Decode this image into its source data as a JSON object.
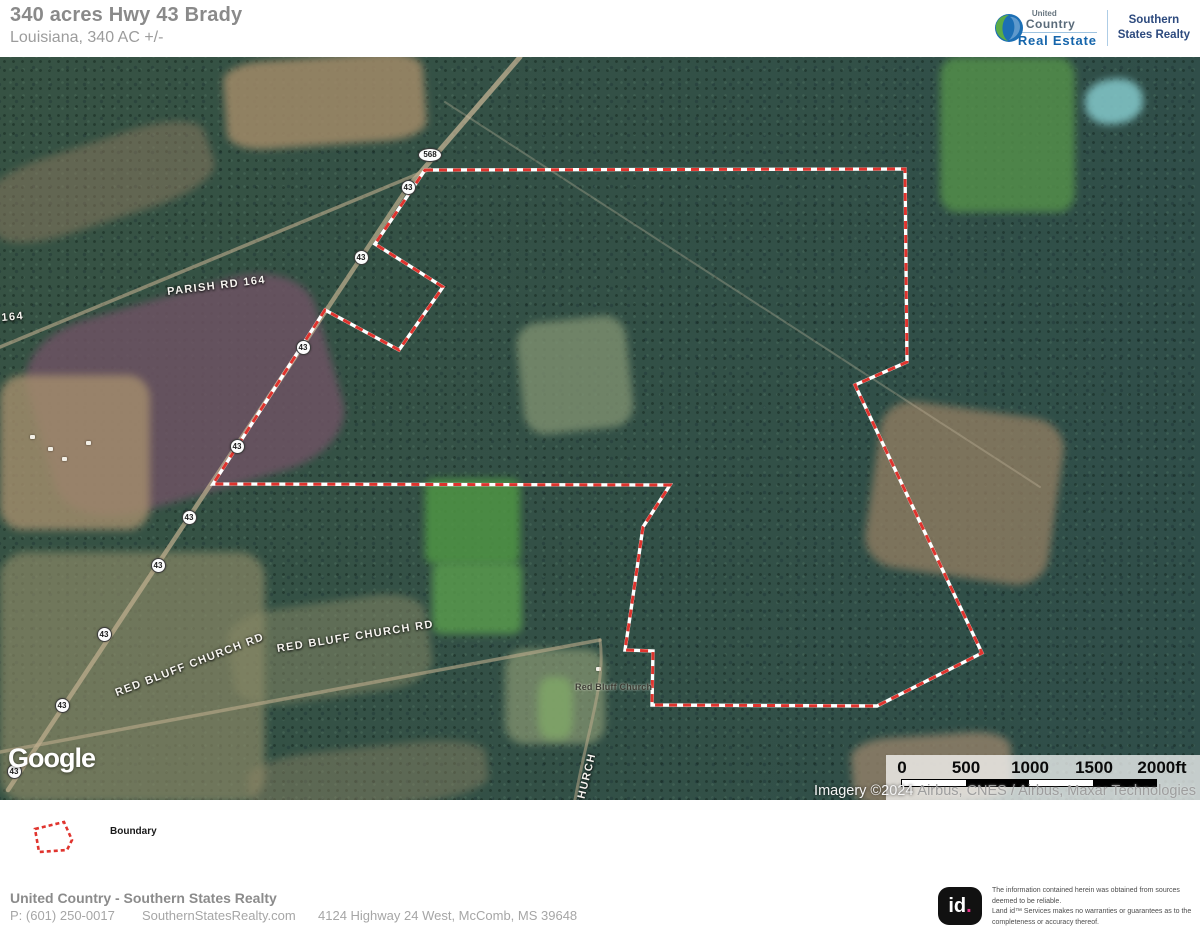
{
  "header": {
    "title": "340 acres Hwy 43 Brady",
    "subtitle": "Louisiana, 340 AC +/-",
    "brand": {
      "united": "United",
      "country": "Country",
      "real_estate": "Real Estate",
      "southern": "Southern",
      "states_realty": "States Realty"
    }
  },
  "map": {
    "boundary_color": "#e0342e",
    "boundary_casing_color": "#ffffff",
    "boundary_points": "425,113 905,112 907,305 855,328 982,596 877,649 652,648 653,594 625,593 631,553 643,470 670,428 213,427 325,253 399,293 443,230 375,187",
    "road_labels": [
      {
        "text": "PARISH RD 164",
        "x": 168,
        "y": 229,
        "rot": -7,
        "cls": "road-label"
      },
      {
        "text": "164",
        "x": 2,
        "y": 255,
        "rot": -5,
        "cls": "road-label"
      },
      {
        "text": "RED BLUFF CHURCH RD",
        "x": 278,
        "y": 586,
        "rot": -9,
        "cls": "road-label"
      },
      {
        "text": "RED BLUFF CHURCH RD",
        "x": 118,
        "y": 630,
        "rot": -21,
        "cls": "road-label"
      },
      {
        "text": "Red Bluff Church",
        "x": 575,
        "y": 625,
        "rot": 0,
        "cls": "poi-label"
      },
      {
        "text": "CHURCH",
        "x": 585,
        "y": 740,
        "rot": -76,
        "cls": "road-label"
      }
    ],
    "shields": [
      {
        "label": "568",
        "x": 430,
        "y": 98,
        "shape": "oval"
      },
      {
        "label": "43",
        "x": 408,
        "y": 130,
        "shape": "circle"
      },
      {
        "label": "43",
        "x": 361,
        "y": 200,
        "shape": "circle"
      },
      {
        "label": "43",
        "x": 303,
        "y": 290,
        "shape": "circle"
      },
      {
        "label": "43",
        "x": 237,
        "y": 389,
        "shape": "circle"
      },
      {
        "label": "43",
        "x": 189,
        "y": 460,
        "shape": "circle"
      },
      {
        "label": "43",
        "x": 158,
        "y": 508,
        "shape": "circle"
      },
      {
        "label": "43",
        "x": 104,
        "y": 577,
        "shape": "circle"
      },
      {
        "label": "43",
        "x": 62,
        "y": 648,
        "shape": "circle"
      },
      {
        "label": "43",
        "x": 14,
        "y": 714,
        "shape": "circle"
      }
    ],
    "google_logo": "Google",
    "scale_bar": {
      "ticks": [
        "0",
        "500",
        "1000",
        "1500",
        "2000ft"
      ]
    },
    "attribution": {
      "prefix": "Imagery ©2024",
      "sources": "Airbus, CNES / Airbus, Maxar Technologies"
    }
  },
  "legend": {
    "boundary_label": "Boundary"
  },
  "footer": {
    "company": "United Country - Southern States Realty",
    "phone": "P: (601) 250-0017",
    "website": "SouthernStatesRealty.com",
    "address": "4124 Highway 24 West, McComb, MS 39648"
  },
  "land_id": {
    "logo_text": "id",
    "logo_dot": ".",
    "disclaimer_lines": [
      "The information contained herein was obtained from sources",
      "deemed to be reliable.",
      "Land id™ Services makes no warranties or guarantees as to the",
      "completeness or accuracy thereof."
    ]
  }
}
